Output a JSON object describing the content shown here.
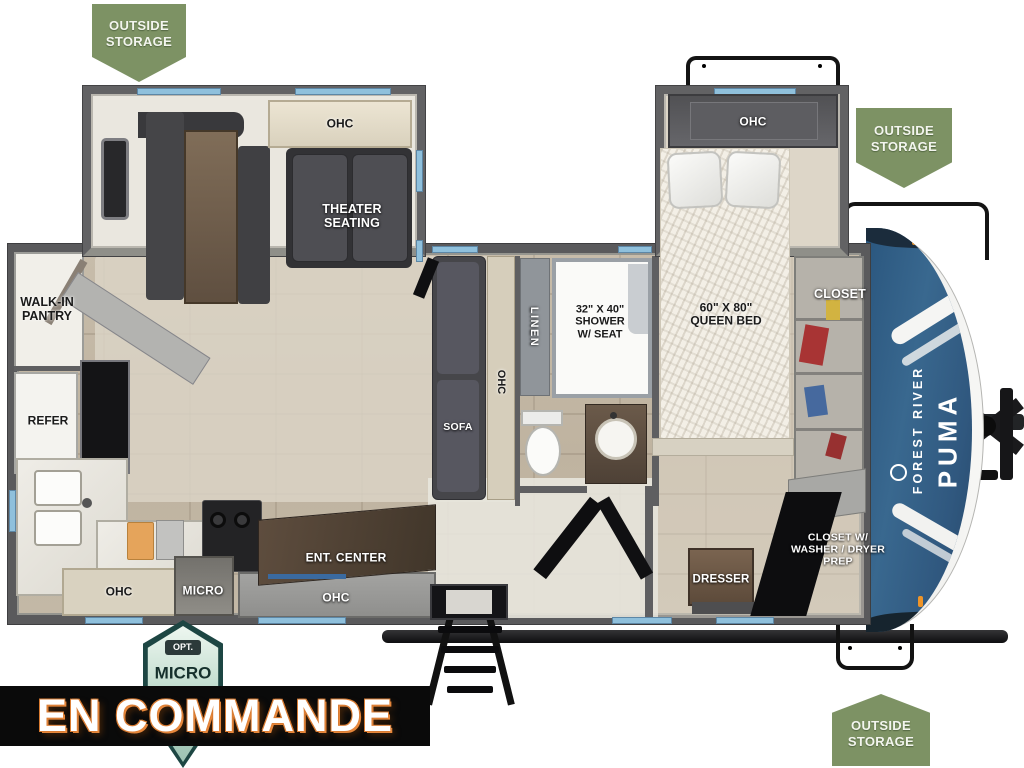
{
  "banner": {
    "label": "EN COMMANDE"
  },
  "badges": {
    "storage_top_left": "OUTSIDE\nSTORAGE",
    "storage_right": "OUTSIDE\nSTORAGE",
    "storage_bottom_right": "OUTSIDE\nSTORAGE",
    "opt_micro_tag": "OPT.",
    "opt_micro_label": "MICRO"
  },
  "brand": {
    "manufacturer": "FOREST RIVER",
    "model": "PUMA"
  },
  "rooms": {
    "ohc_dinette": "OHC",
    "dinette": "DINETTE",
    "theater_seating": "THEATER\nSEATING",
    "walk_in_pantry": "WALK-IN\nPANTRY",
    "refer": "REFER",
    "ohc_kitchen_left": "OHC",
    "micro": "MICRO",
    "ohc_kitchen_center": "OHC",
    "ent_center": "ENT. CENTER",
    "sofa": "SOFA",
    "ohc_sofa": "OHC",
    "linen": "LINEN",
    "shower": "32\" X 40\"\nSHOWER\nW/ SEAT",
    "queen_bed": "60\" X 80\"\nQUEEN BED",
    "ohc_bedroom": "OHC",
    "closet": "CLOSET",
    "dresser": "DRESSER",
    "closet_washer_dryer": "CLOSET W/\nWASHER / DRYER\nPREP"
  },
  "colors": {
    "badge_green": "#7d9264",
    "front_cap_blue": "#2f6190",
    "banner_background": "#0a0a0a",
    "banner_text": "#ffffff",
    "banner_glow_orange": "#e7873b",
    "window_accent_blue": "#8fc0dc"
  }
}
